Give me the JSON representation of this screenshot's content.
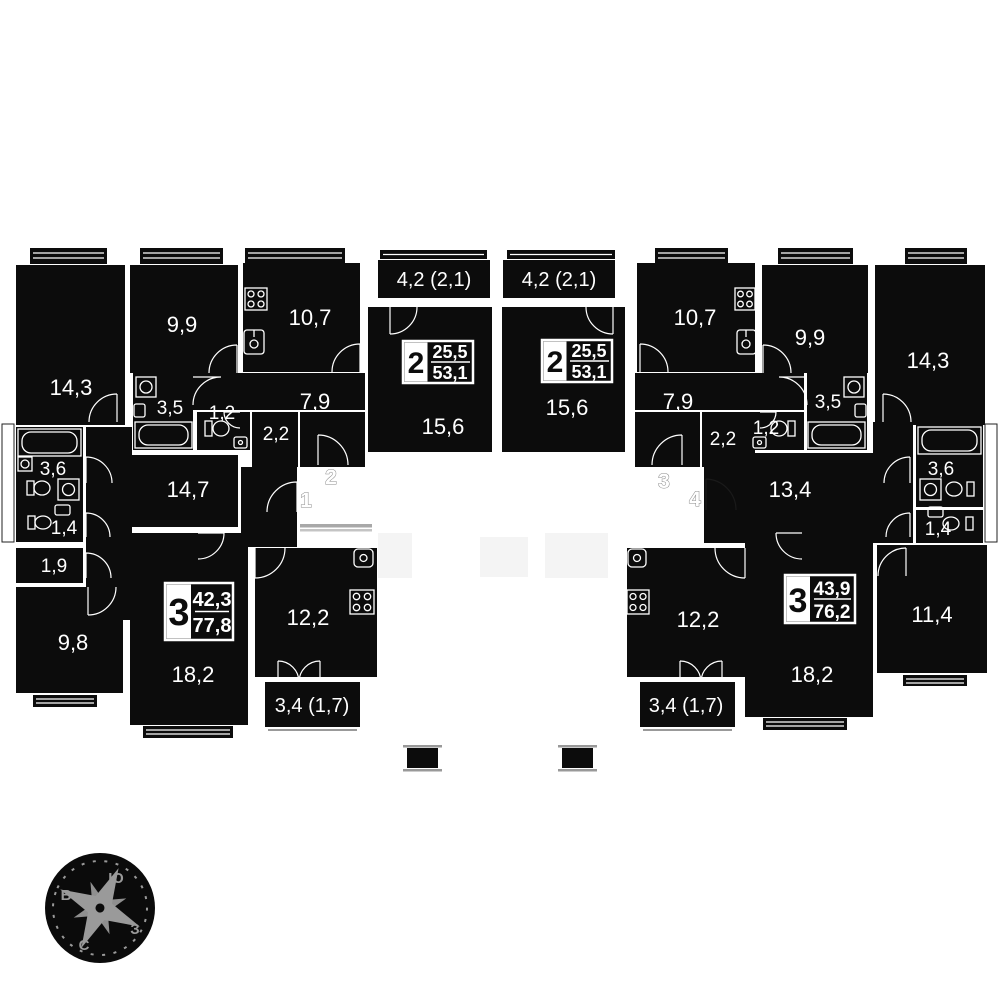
{
  "plan_title": "apartment-floor-plan",
  "colors": {
    "ink": "#0c0c0c",
    "background": "#ffffff",
    "muted_gray": "#9a9a9a",
    "faint_gray": "#f4f4f4"
  },
  "rooms": {
    "r14_3L": "14,3",
    "r9_9L": "9,9",
    "r10_7L": "10,7",
    "r3_5L": "3,5",
    "r1_2L": "1,2",
    "r2_2L": "2,2",
    "r7_9L": "7,9",
    "r14_7": "14,7",
    "r3_6L": "3,6",
    "r1_4L": "1,4",
    "r1_9L": "1,9",
    "r9_8": "9,8",
    "r18_2L": "18,2",
    "r12_2L": "12,2",
    "b3_4L": "3,4 (1,7)",
    "b4_2L": "4,2 (2,1)",
    "r15_6L": "15,6",
    "b4_2R": "4,2 (2,1)",
    "r15_6R": "15,6",
    "r10_7R": "10,7",
    "r9_9R": "9,9",
    "r14_3R": "14,3",
    "r7_9R": "7,9",
    "r2_2R": "2,2",
    "r1_2R": "1,2",
    "r3_5R": "3,5",
    "r13_4": "13,4",
    "r3_6R": "3,6",
    "r1_4R": "1,4",
    "r11_4": "11,4",
    "r12_2R": "12,2",
    "r18_2R": "18,2",
    "b3_4R": "3,4 (1,7)"
  },
  "badges": [
    {
      "num": "2",
      "living": "25,5",
      "total": "53,1"
    },
    {
      "num": "2",
      "living": "25,5",
      "total": "53,1"
    },
    {
      "num": "3",
      "living": "42,3",
      "total": "77,8"
    },
    {
      "num": "3",
      "living": "43,9",
      "total": "76,2"
    }
  ],
  "entrances": {
    "f1": "1",
    "f2": "2",
    "f3": "3",
    "f4": "4"
  },
  "compass": {
    "south": "Ю",
    "east": "В",
    "west": "З",
    "north": "С"
  }
}
